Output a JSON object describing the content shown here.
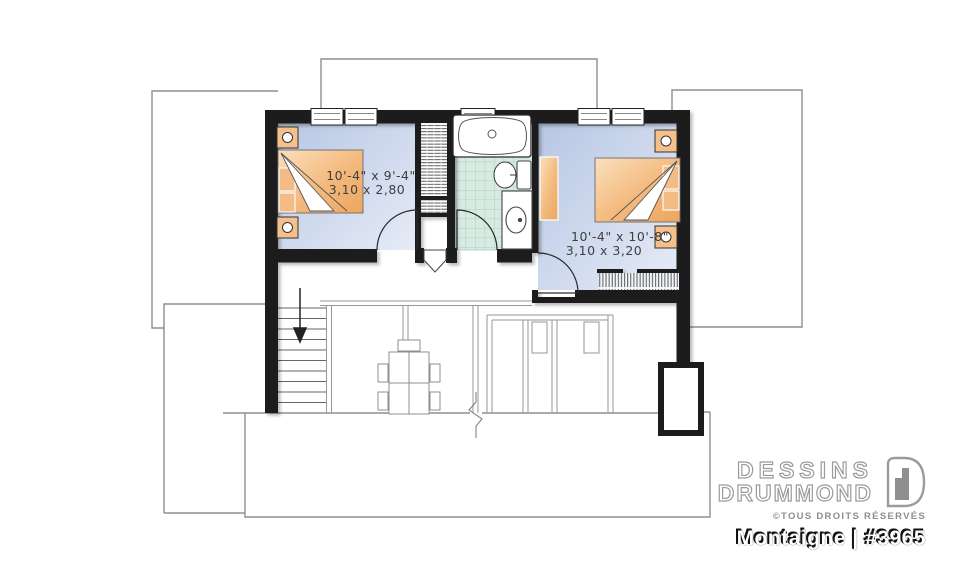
{
  "plan": {
    "bedroom1": {
      "dim_imperial": "10'-4\" x 9'-4\"",
      "dim_metric": "3,10 x 2,80"
    },
    "bedroom2": {
      "dim_imperial": "10'-4\" x 10'-8\"",
      "dim_metric": "3,10 x 3,20"
    },
    "stairs_direction": "down-arrow"
  },
  "branding": {
    "name_line1": "DESSINS",
    "name_line2": "DRUMMOND",
    "rights": "©TOUS DROITS RÉSERVÉS",
    "model": "Montaigne | #3965",
    "logo_icon": "drummond-door-icon"
  },
  "colors": {
    "wall": "#1c1c1c",
    "floor_blue_light": "#e6ecf7",
    "floor_blue": "#bccbe6",
    "furniture_orange": "#eda65f",
    "furniture_orange_light": "#fbe0bd",
    "tile_green": "#d8ebe2",
    "tile_grid": "#b4d4c6",
    "roof_line": "#8f8f8f",
    "logo_gray": "#9b9b9b"
  }
}
